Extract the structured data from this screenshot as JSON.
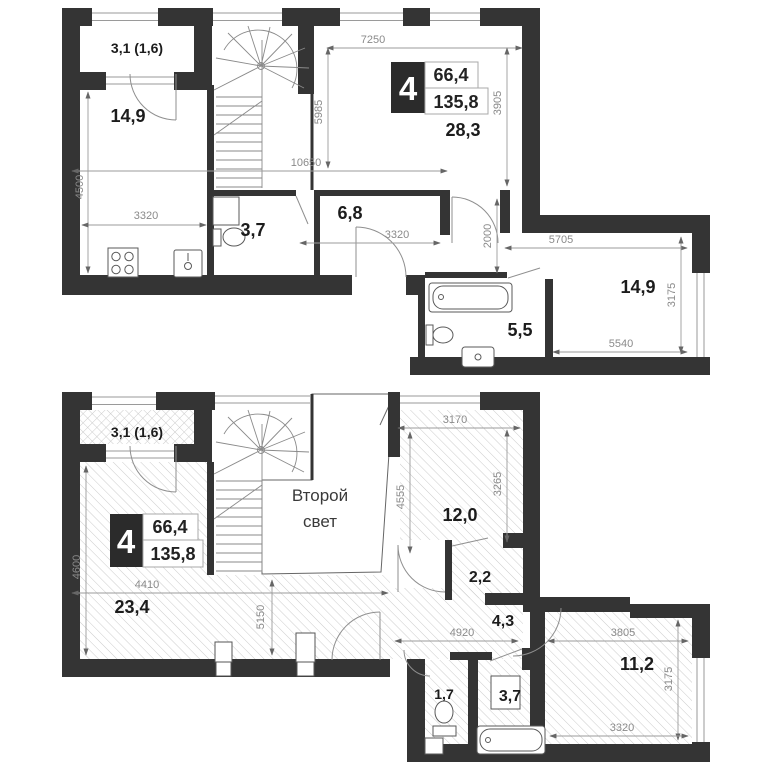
{
  "document": {
    "type": "apartment duplex floor plan",
    "background": "#ffffff",
    "wall_color": "#343434",
    "dim_color": "#8a8a8a"
  },
  "upper_plan": {
    "badge": {
      "room_count": "4",
      "area_live": "66,4",
      "area_total": "135,8"
    },
    "rooms": {
      "balcony": "3,1 (1,6)",
      "bedroom": "14,9",
      "living": "28,3",
      "bathroom": "3,7",
      "hall": "6,8",
      "kitchen_room": "14,9",
      "bathroom_2": "5,5"
    },
    "dims": {
      "top_width": "7250",
      "living_height": "3905",
      "stair_height": "5985",
      "mid_width": "10650",
      "left_height": "4500",
      "kitchen_width": "3320",
      "hall_width": "3320",
      "corridor_height": "2000",
      "room_top_width": "5705",
      "room_right_height": "3175",
      "room_bottom_width": "5540"
    }
  },
  "lower_plan": {
    "badge": {
      "room_count": "4",
      "area_live": "66,4",
      "area_total": "135,8"
    },
    "rooms": {
      "balcony": "3,1 (1,6)",
      "void_line1": "Второй",
      "void_line2": "свет",
      "bedroom": "12,0",
      "closet": "2,2",
      "hall": "4,3",
      "living": "23,4",
      "bedroom_2": "11,2",
      "wc": "1,7",
      "bathroom": "3,7"
    },
    "dims": {
      "bedroom_width": "3170",
      "bedroom_height": "3265",
      "void_height": "4555",
      "left_height": "4600",
      "living_width": "4410",
      "living_height": "5150",
      "hall_width": "4920",
      "bedroom2_width": "3805",
      "bedroom2_height": "3175",
      "bedroom2_bottom": "3320"
    }
  }
}
